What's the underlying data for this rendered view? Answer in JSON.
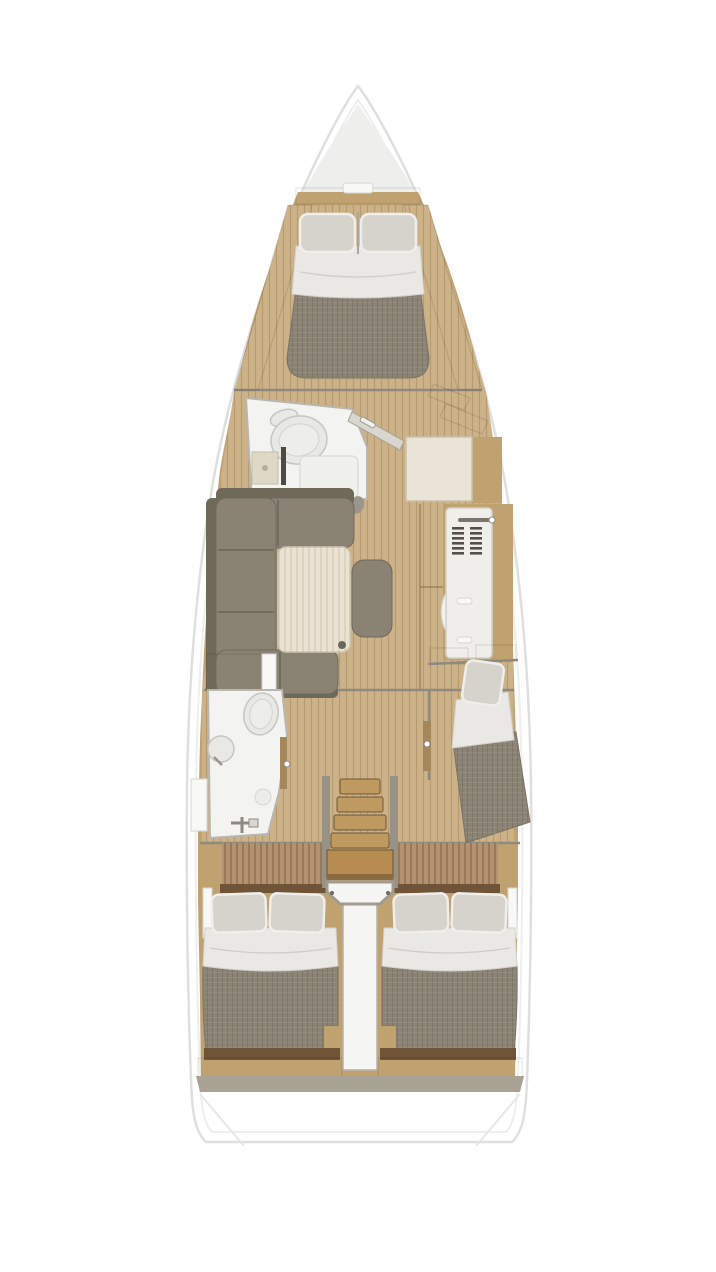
{
  "meta": {
    "label": "Sailing yacht interior layout plan, top-down view",
    "type": "floor-plan"
  },
  "colors": {
    "hullEdge": "#dfdfdd",
    "hullShadow": "#eeeeec",
    "wood": "#c0a271",
    "woodDark": "#a5875c",
    "woodTrimDark": "#6f5438",
    "floor": "#cdb288",
    "floorStripe": "#b3935f",
    "deckPanel": "#b29270",
    "fabricDark": "#8b8374",
    "sofa": "#8a8373",
    "sofaShadow": "#6f6959",
    "bedding": "#e9e8e4",
    "pillow": "#d6d3cc",
    "bath": "#f3f3f1",
    "fixture": "#e8e8e5",
    "wall": "#8f8a7e",
    "tableTop": "#eae3d3",
    "cabinet": "#e9e4d6",
    "galley": "#efeeea",
    "stairWood": "#bf9a60",
    "stairBig": "#b68c50",
    "landing": "#f5f5f3",
    "trimGray": "#a9a396"
  },
  "elements": [
    "hull-outline",
    "v-berth-double-bed",
    "forward-head-toilet",
    "forward-head-sink",
    "forward-head-shower",
    "nav-seat",
    "chart-table",
    "galley-unit-with-vents",
    "u-shaped-settee",
    "saloon-table",
    "centerline-bench",
    "aft-head-toilet",
    "aft-head-sink",
    "aft-head-shower-mixer",
    "companionway-stairs",
    "mid-cabin-single-berth",
    "aft-cabin-port-double-bed",
    "aft-cabin-starboard-double-bed",
    "stern-transom"
  ]
}
